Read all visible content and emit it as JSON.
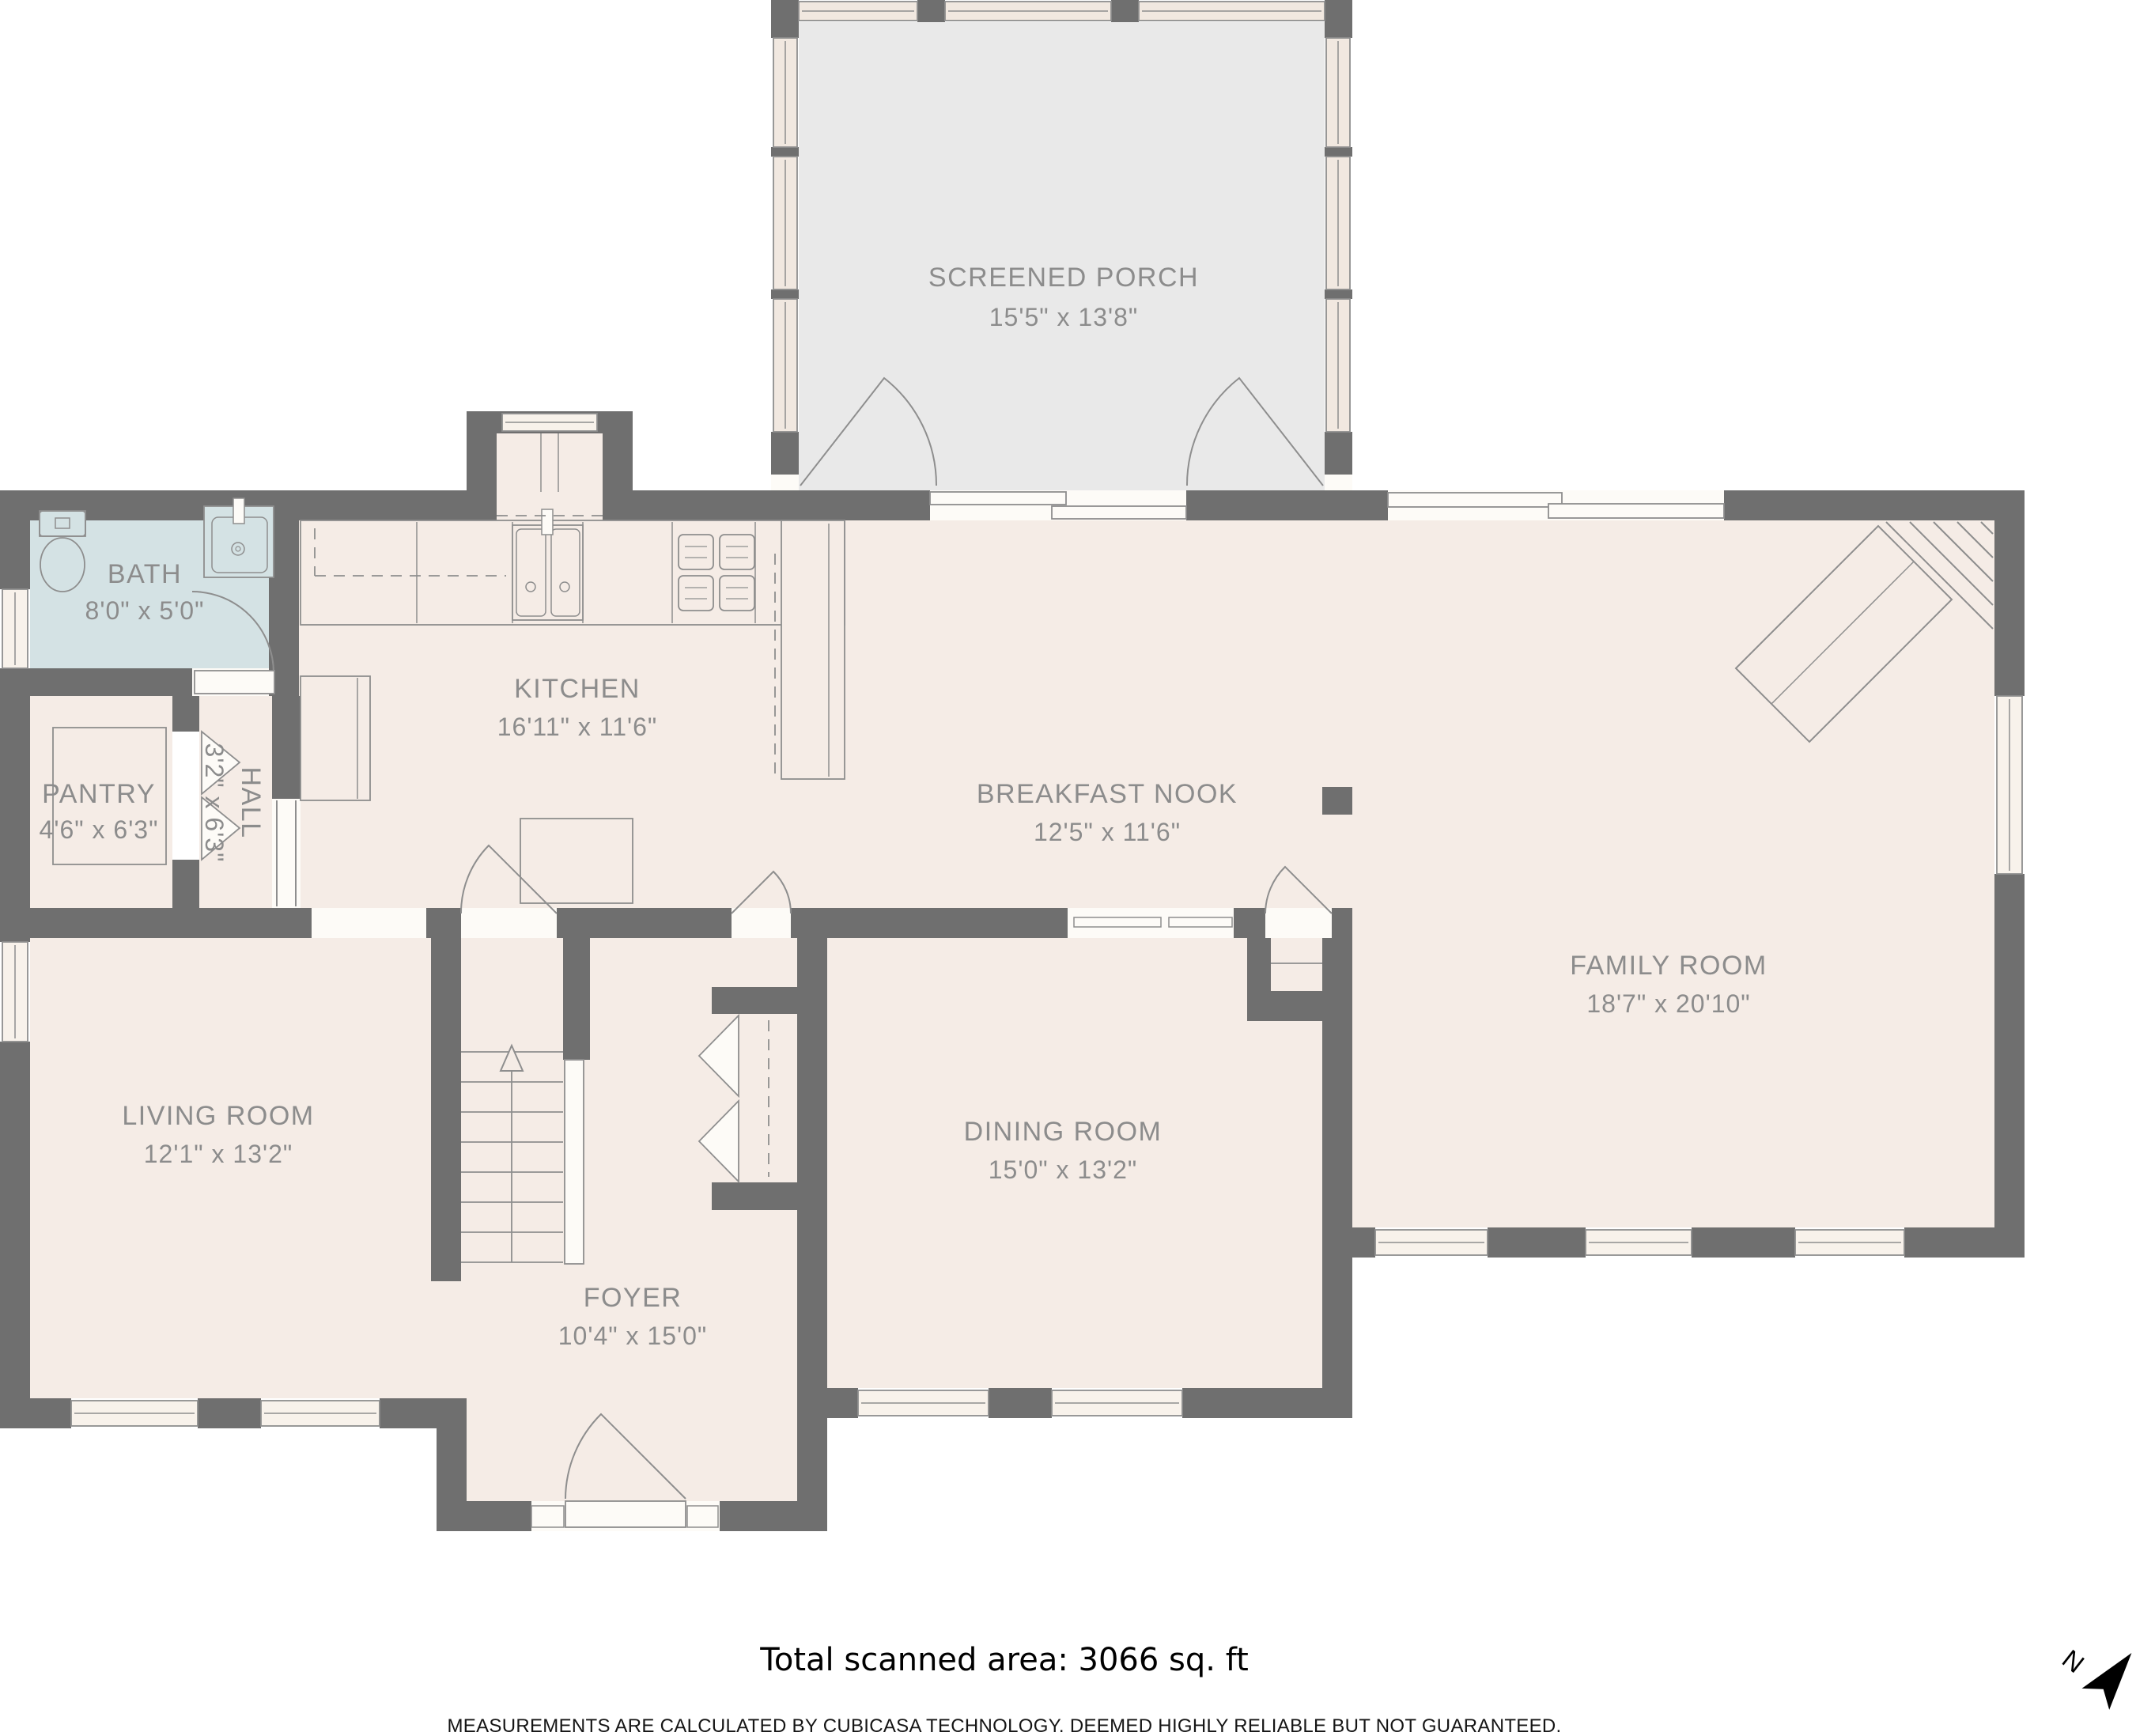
{
  "plan": {
    "rooms": [
      {
        "id": "screened-porch",
        "name": "SCREENED PORCH",
        "dims": "15'5\" x 13'8\""
      },
      {
        "id": "bath",
        "name": "BATH",
        "dims": "8'0\" x 5'0\""
      },
      {
        "id": "kitchen",
        "name": "KITCHEN",
        "dims": "16'11\" x 11'6\""
      },
      {
        "id": "breakfast-nook",
        "name": "BREAKFAST NOOK",
        "dims": "12'5\" x 11'6\""
      },
      {
        "id": "family-room",
        "name": "FAMILY ROOM",
        "dims": "18'7\" x 20'10\""
      },
      {
        "id": "pantry",
        "name": "PANTRY",
        "dims": "4'6\" x 6'3\""
      },
      {
        "id": "hall",
        "name": "HALL",
        "dims": "3'2\" x 6'3\""
      },
      {
        "id": "living-room",
        "name": "LIVING ROOM",
        "dims": "12'1\" x 13'2\""
      },
      {
        "id": "dining-room",
        "name": "DINING ROOM",
        "dims": "15'0\" x 13'2\""
      },
      {
        "id": "foyer",
        "name": "FOYER",
        "dims": "10'4\" x 15'0\""
      }
    ],
    "footer": {
      "total_area": "Total scanned area: 3066 sq. ft",
      "disclaimer": "MEASUREMENTS ARE CALCULATED BY CUBICASA TECHNOLOGY. DEEMED HIGHLY RELIABLE BUT NOT GUARANTEED."
    },
    "compass": {
      "north_label": "N"
    },
    "colors": {
      "wall": "#6f6f6f",
      "floor": "#f5ece6",
      "bath_floor": "#d4e2e4",
      "porch_floor": "#e9e9e9",
      "opening": "#fdfbf7",
      "window": "#f8f2eb",
      "porch_window": "#f1e8e0",
      "fixture_line": "#8e8e8e",
      "label_text": "#8c8c8c"
    }
  }
}
